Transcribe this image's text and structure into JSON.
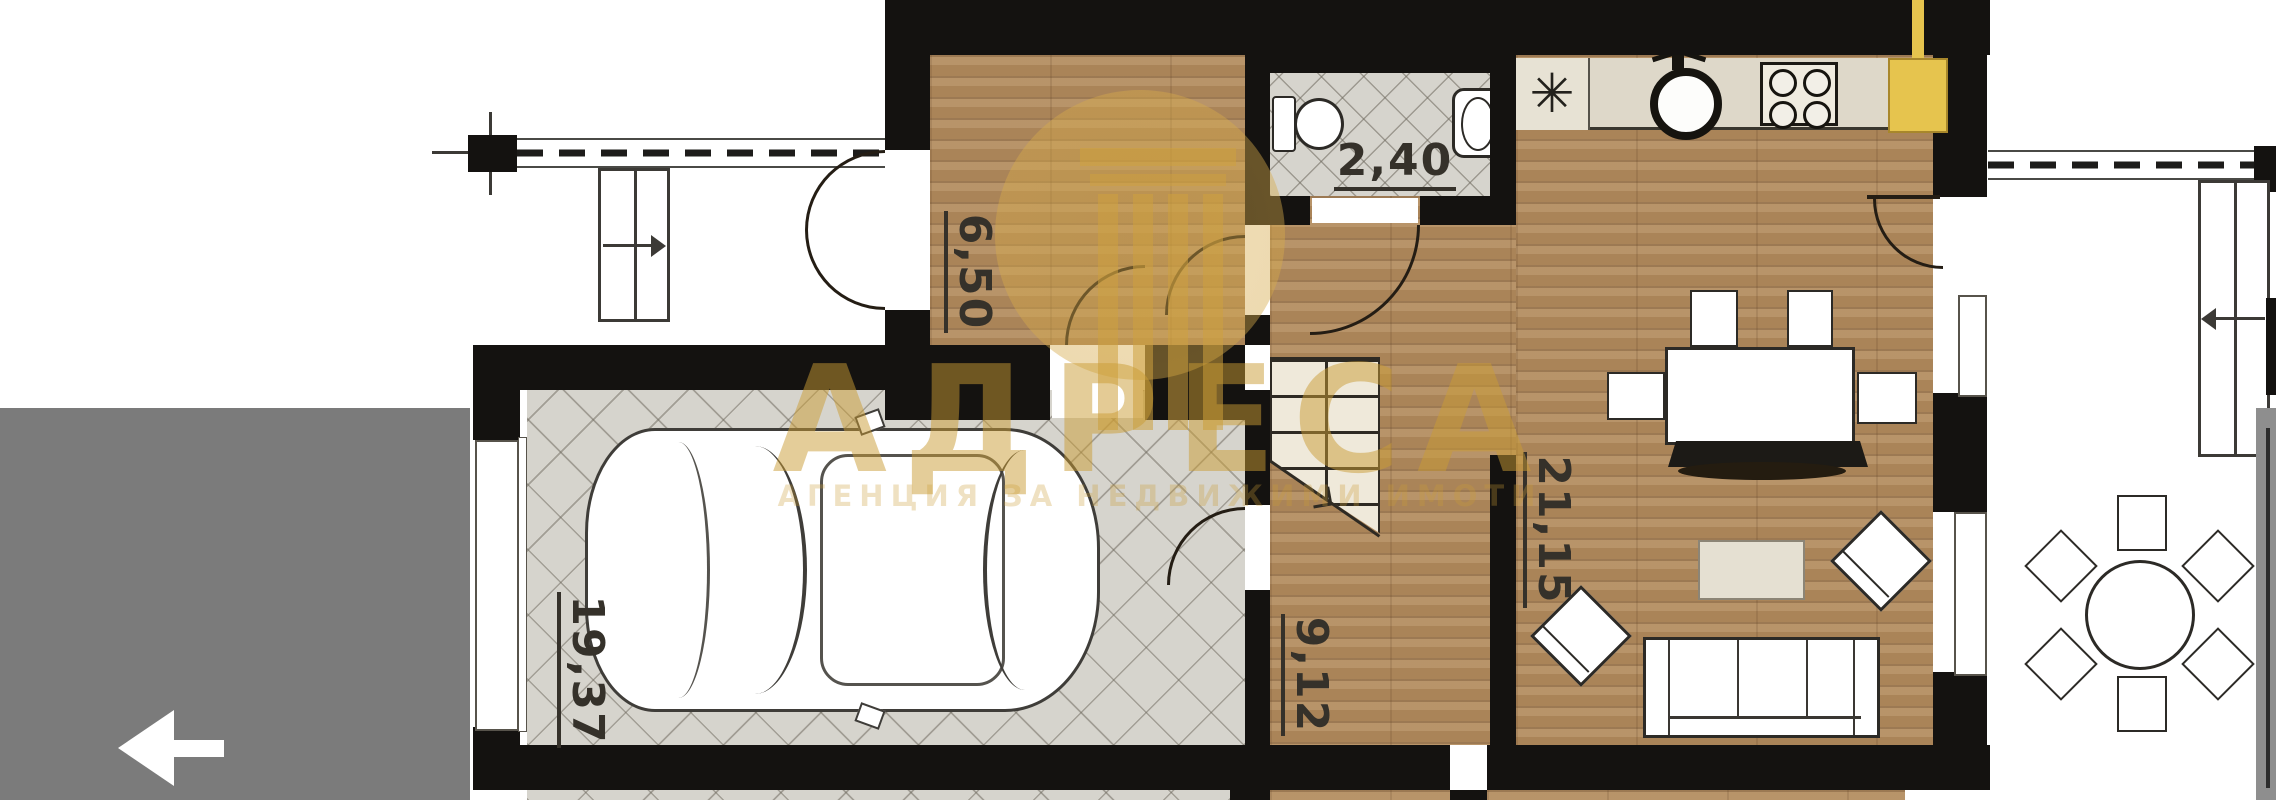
{
  "watermark": {
    "brand": "АДРЕСА",
    "subtitle": "АГЕНЦИЯ ЗА НЕДВИЖИМИ ИМОТИ"
  },
  "rooms": {
    "hall": {
      "area": "6,50"
    },
    "bathroom": {
      "area": "2,40"
    },
    "corridor": {
      "area": "9,12"
    },
    "living_room": {
      "area": "21,15"
    },
    "garage": {
      "area": "19,37"
    }
  },
  "icons": {
    "back_arrow": "←",
    "boiler": "✳"
  },
  "colors": {
    "overlay_gray": "#7b7b7b",
    "watermark_gold": "#cfa045",
    "accent_yellow": "#e6c44e",
    "wall_black": "#141210"
  }
}
